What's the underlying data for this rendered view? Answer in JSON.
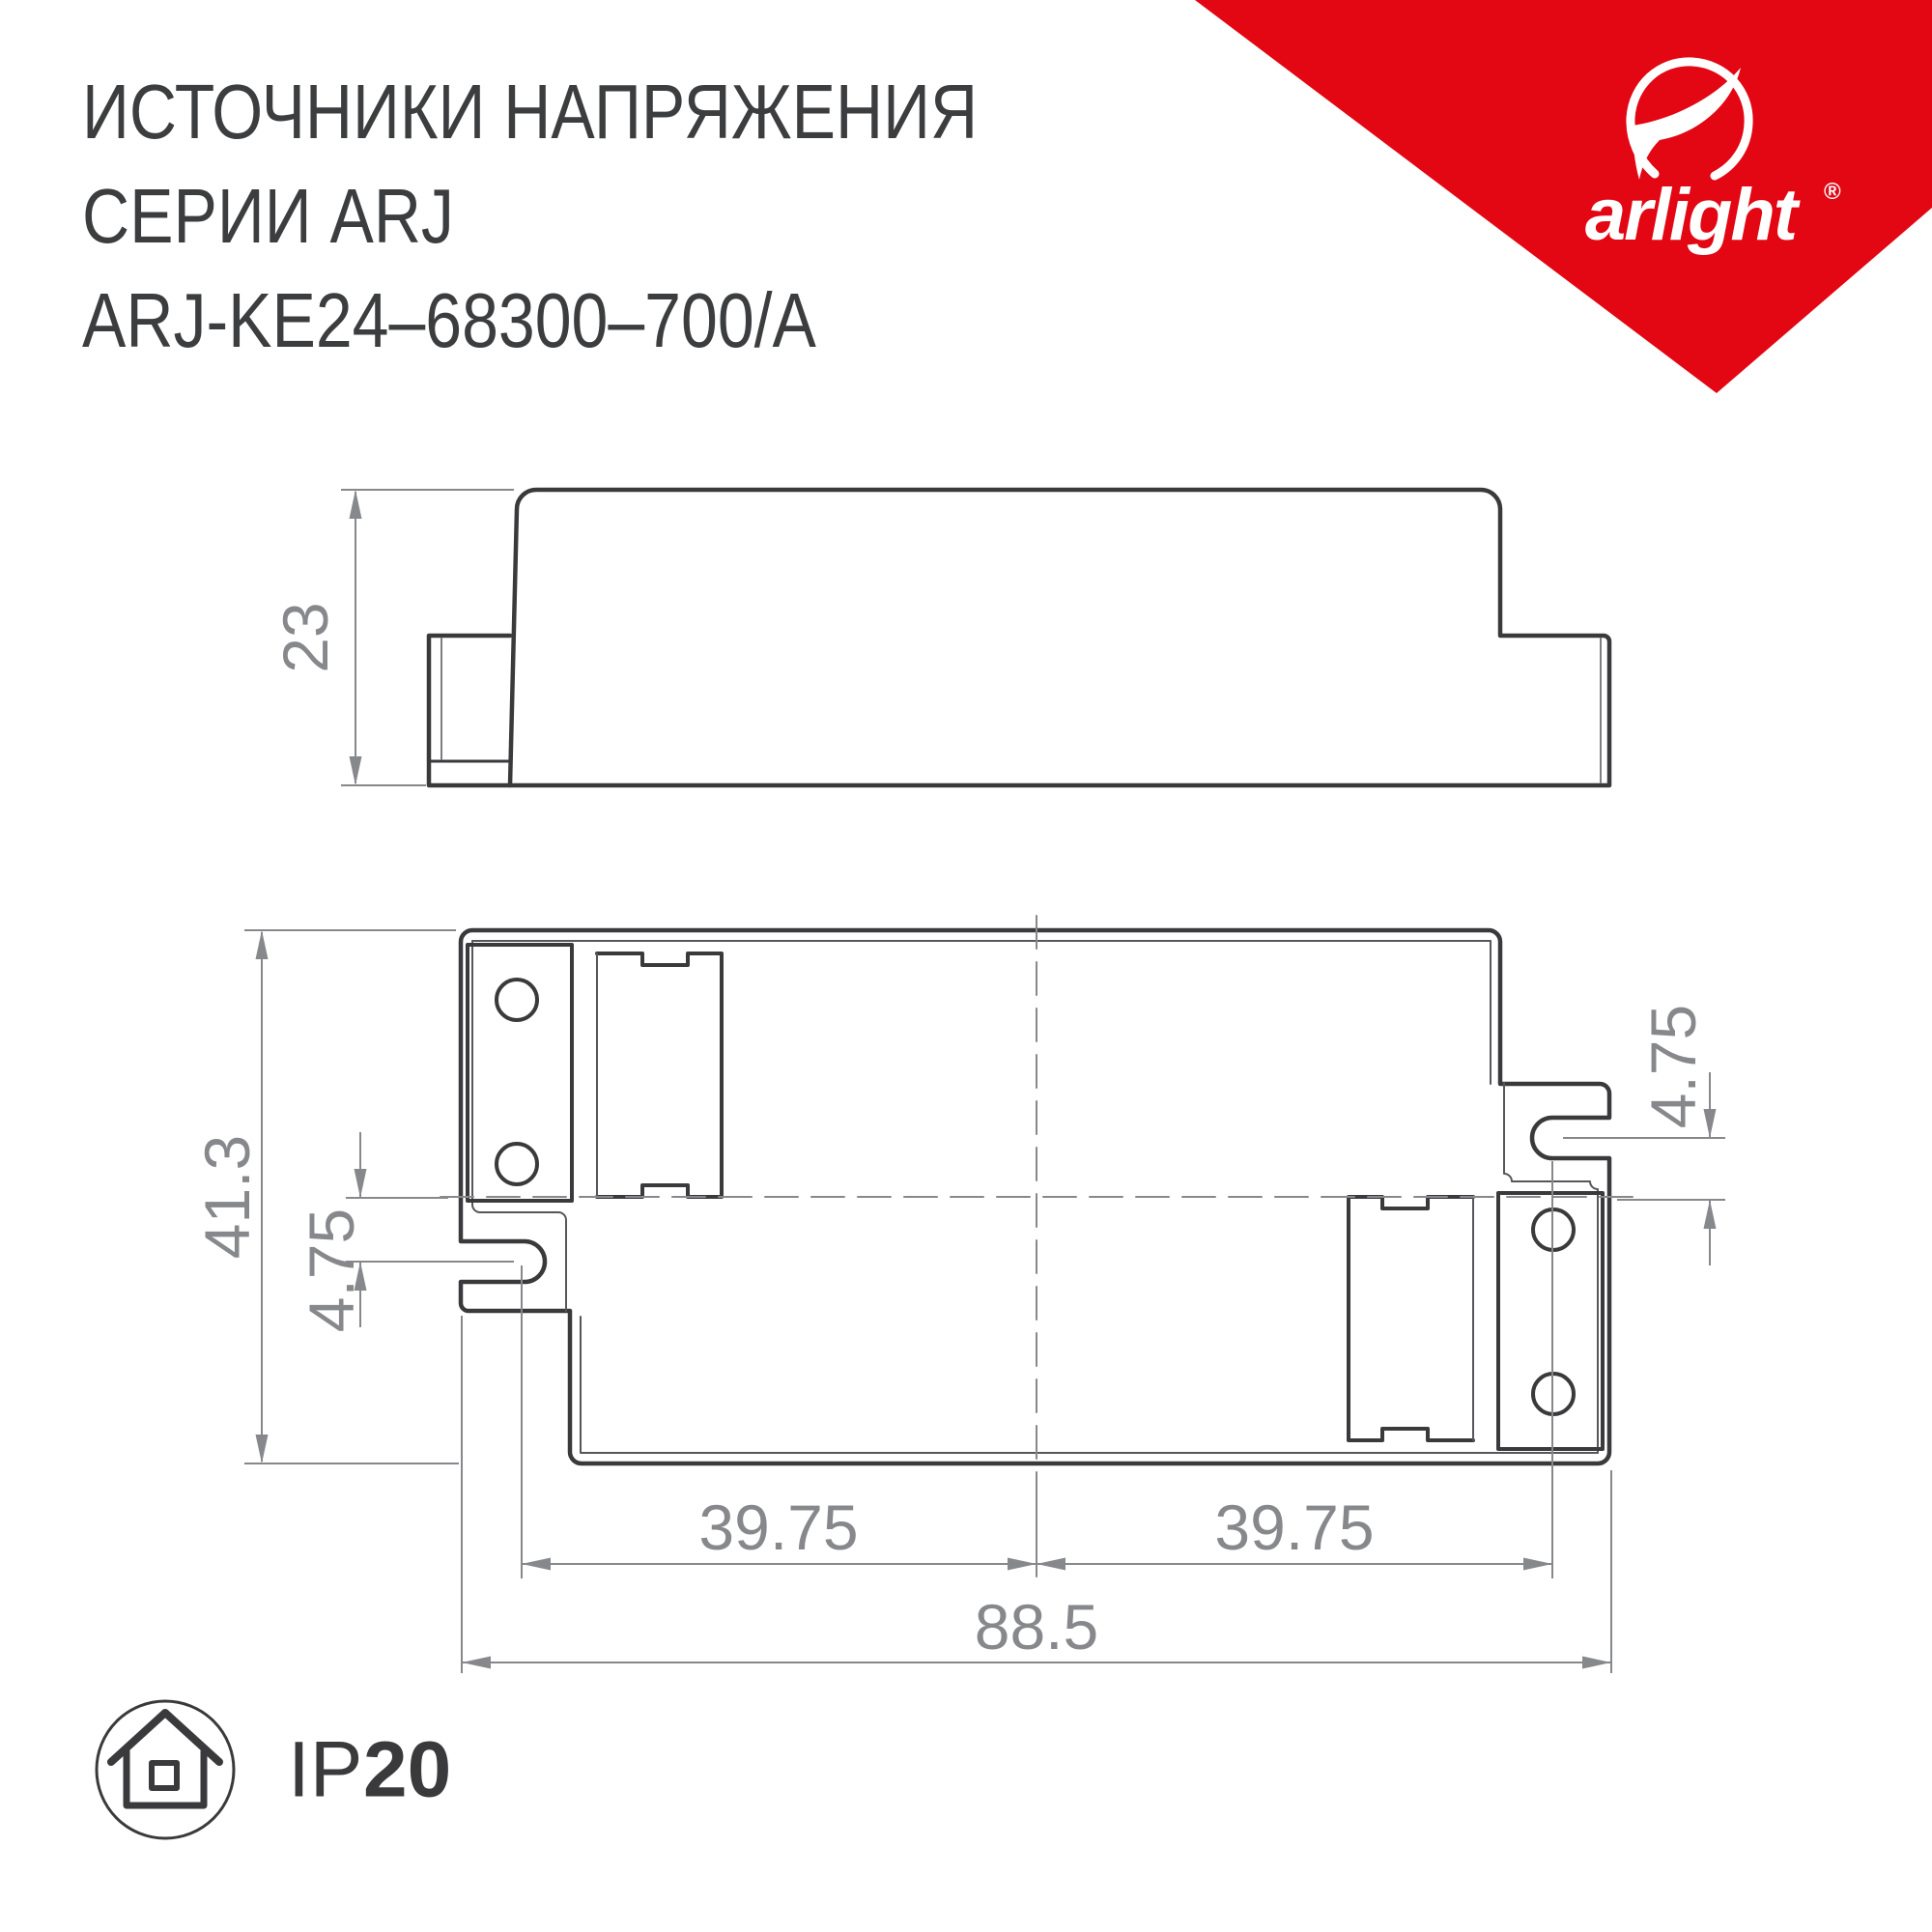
{
  "header": {
    "title_line1": "ИСТОЧНИКИ НАПРЯЖЕНИЯ",
    "title_line2": "СЕРИИ ARJ",
    "title_line3": "ARJ-KE24–68300–700/A"
  },
  "brand": {
    "logo_text": "arlight",
    "registered_mark": "®",
    "triangle_color": "#e30613",
    "logo_icon": "arlight-swoosh-icon"
  },
  "drawing": {
    "stroke_color": "#3a3a3c",
    "dim_color": "#86888b",
    "side_view": {
      "height_mm": "23"
    },
    "top_view": {
      "overall_height_mm": "41.3",
      "slot_offset_left_mm": "4.75",
      "slot_offset_right_mm": "4.75",
      "hole_spacing_left_mm": "39.75",
      "hole_spacing_right_mm": "39.75",
      "overall_width_mm": "88.5"
    }
  },
  "footer": {
    "ip_prefix": "IP",
    "ip_value": "20",
    "badge_icon": "house-in-circle-icon"
  }
}
